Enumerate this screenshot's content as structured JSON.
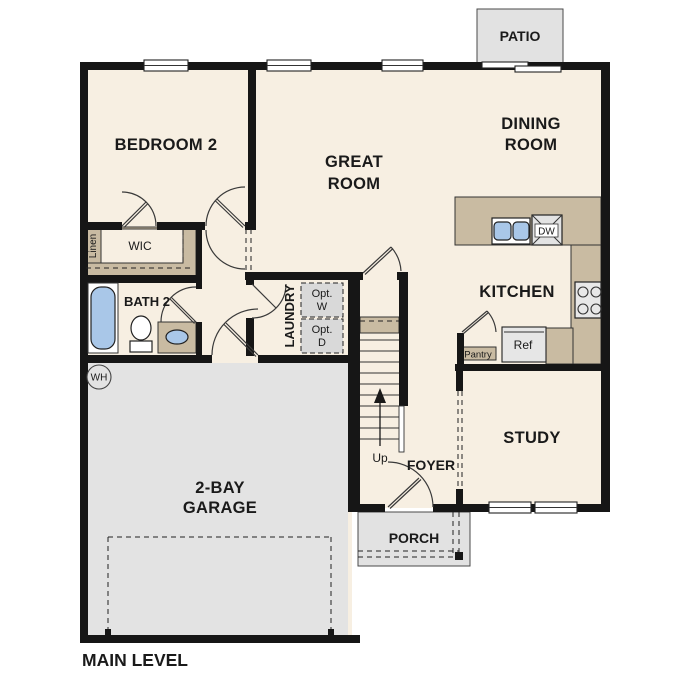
{
  "floor_plan": {
    "level_title": "MAIN LEVEL",
    "rooms": {
      "bedroom2": {
        "label": "BEDROOM 2"
      },
      "great_room": {
        "line1": "GREAT",
        "line2": "ROOM"
      },
      "dining_room": {
        "line1": "DINING",
        "line2": "ROOM"
      },
      "kitchen": {
        "label": "KITCHEN"
      },
      "study": {
        "label": "STUDY"
      },
      "foyer": {
        "label": "FOYER"
      },
      "laundry": {
        "label": "LAUNDRY"
      },
      "bath2": {
        "label": "BATH 2"
      },
      "wic": {
        "label": "WIC"
      },
      "linen": {
        "label": "Linen"
      },
      "garage": {
        "line1": "2-BAY",
        "line2": "GARAGE"
      },
      "patio": {
        "label": "PATIO"
      },
      "porch": {
        "label": "PORCH"
      }
    },
    "features": {
      "stairs_direction": "Up",
      "water_heater": "WH",
      "pantry": "Pantry",
      "dishwasher": "DW",
      "refrigerator": "Ref",
      "optional_washer": {
        "line1": "Opt.",
        "line2": "W"
      },
      "optional_dryer": {
        "line1": "Opt.",
        "line2": "D"
      }
    },
    "colors": {
      "floor": "#f7efe2",
      "counter_tan": "#c9bba2",
      "outdoor_gray": "#e2e2e2",
      "optional_gray": "#d9d9d9",
      "fixture_blue": "#a9c7e8",
      "wall_black": "#161616",
      "background": "#ffffff"
    }
  }
}
